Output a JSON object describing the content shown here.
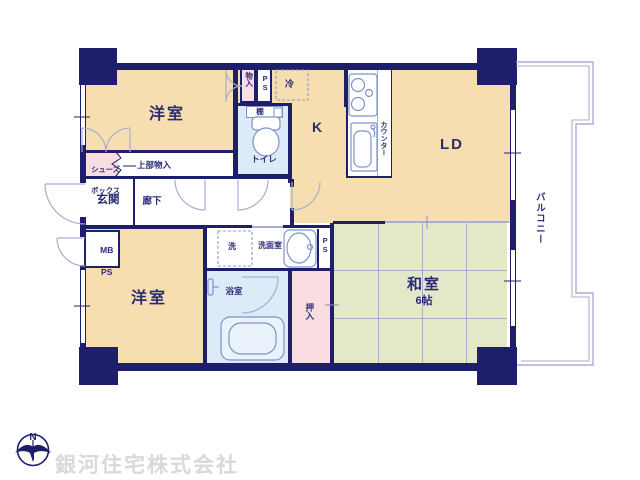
{
  "plan": {
    "rooms": {
      "western_room_top": "洋室",
      "western_room_bottom": "洋室",
      "kitchen": "K",
      "living_dining": "LD",
      "japanese_room": "和室",
      "japanese_room_size": "6帖",
      "entrance": "玄関",
      "hallway": "廊下",
      "toilet": "トイレ",
      "washroom": "洗面室",
      "bathroom": "浴室",
      "closet_oshiire": "押入",
      "balcony": "バルコニー"
    },
    "fixtures": {
      "storage_monoire": "物入",
      "pipe_space_top": "PS",
      "refrigerator": "冷",
      "shelf": "棚",
      "counter": "カウンター",
      "shoe_box_line1": "シューズ",
      "shoe_box_line2": "ボックス",
      "upper_storage": "上部物入",
      "meter_box_line1": "MB",
      "meter_box_line2": "PS",
      "washer": "洗",
      "pipe_space_right": "PS"
    },
    "compass": {
      "north_label": "N"
    },
    "footer": {
      "company": "銀河住宅株式会社"
    },
    "colors": {
      "wall_navy": "#1e1e6b",
      "floor_beige": "#f6deb0",
      "tatami_green": "#e3e8c9",
      "closet_pink": "#fadde0",
      "wet_area_blue": "#dcebf7",
      "exterior_outline": "#a9aed1",
      "fixture_line": "#7d93c9",
      "watermark_gray": "#d9d9d9"
    }
  }
}
